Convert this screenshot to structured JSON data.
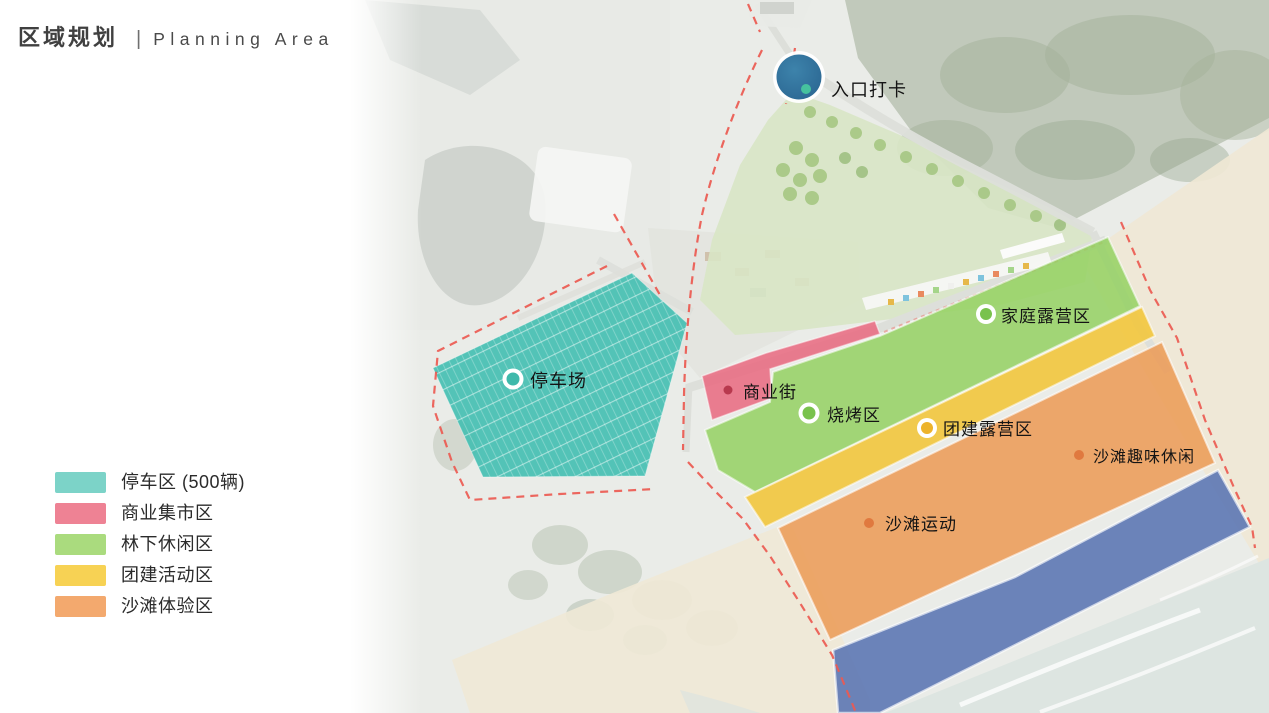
{
  "header": {
    "title_zh": "区域规划",
    "separator": "|",
    "title_en": "Planning Area"
  },
  "legend": {
    "items": [
      {
        "id": "parking-zone",
        "label": "停车区 (500辆)",
        "swatch_color": "#7cd3c8",
        "map_color": "#45bfb2"
      },
      {
        "id": "commercial-market-zone",
        "label": "商业集市区",
        "swatch_color": "#ee8294",
        "map_color": "#e9687f"
      },
      {
        "id": "forest-leisure-zone",
        "label": "林下休闲区",
        "swatch_color": "#aadb7e",
        "map_color": "#94d161"
      },
      {
        "id": "team-building-zone",
        "label": "团建活动区",
        "swatch_color": "#f7d254",
        "map_color": "#f2c63d"
      },
      {
        "id": "beach-experience-zone",
        "label": "沙滩体验区",
        "swatch_color": "#f3a96e",
        "map_color": "#ec9c58"
      }
    ]
  },
  "map": {
    "boundary_color": "#ec5a51",
    "blue_strip_color": "#5b76ba",
    "markers": [
      {
        "id": "entrance-checkin",
        "label": "入口打卡",
        "color": "#316f9c",
        "dot_color": "#46c29e"
      },
      {
        "id": "parking-lot",
        "label": "停车场",
        "color": "#3fb9ab"
      },
      {
        "id": "commercial-street",
        "label": "商业街",
        "color": "#b8394e"
      },
      {
        "id": "bbq-area",
        "label": "烧烤区",
        "color": "#79c24d"
      },
      {
        "id": "family-camping",
        "label": "家庭露营区",
        "color": "#79c24d"
      },
      {
        "id": "team-camping",
        "label": "团建露营区",
        "color": "#edb32b"
      },
      {
        "id": "beach-fun-leisure",
        "label": "沙滩趣味休闲",
        "color": "#e0793f"
      },
      {
        "id": "beach-sports",
        "label": "沙滩运动",
        "color": "#e0793f"
      }
    ]
  }
}
